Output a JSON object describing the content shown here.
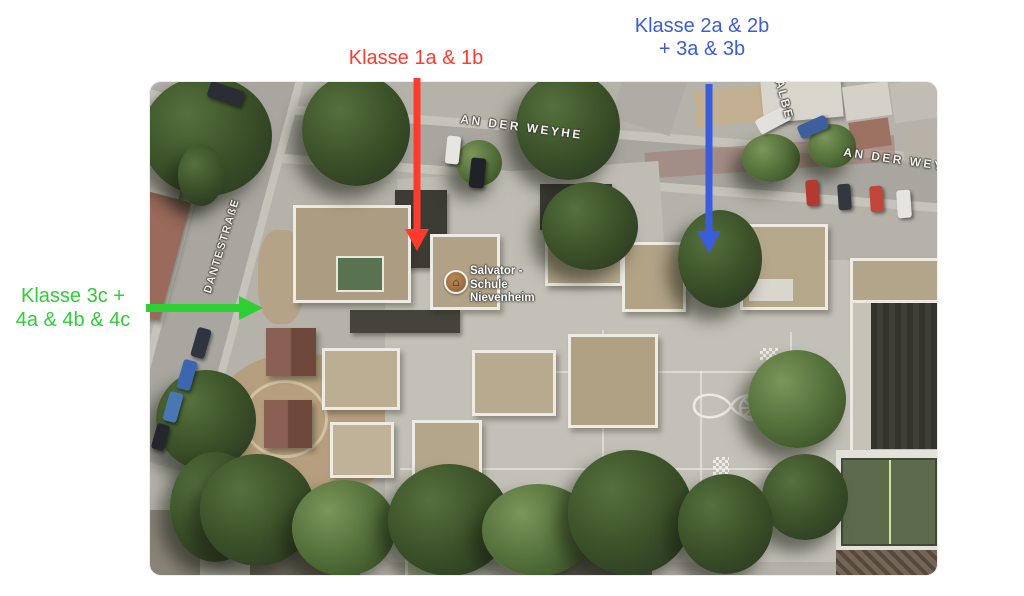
{
  "annotations": {
    "red": {
      "text": "Klasse 1a & 1b",
      "color": "#ff3b30"
    },
    "blue": {
      "line1": "Klasse 2a & 2b",
      "line2": "+ 3a & 3b",
      "color": "#3b5cdb"
    },
    "green": {
      "line1": "Klasse 3c +",
      "line2": "4a & 4b & 4c",
      "color": "#2dcf35"
    }
  },
  "map": {
    "streets": {
      "an_der_weyhe": "AN DER WEYHE",
      "an_der_wey_clipped": "AN DER WEY",
      "dantestrasse": "DANTESTRAßE",
      "albe_clipped": "ALBE"
    },
    "poi": {
      "line1": "Salvator -",
      "line2": "Schule",
      "line3": "Nievenheim"
    }
  }
}
